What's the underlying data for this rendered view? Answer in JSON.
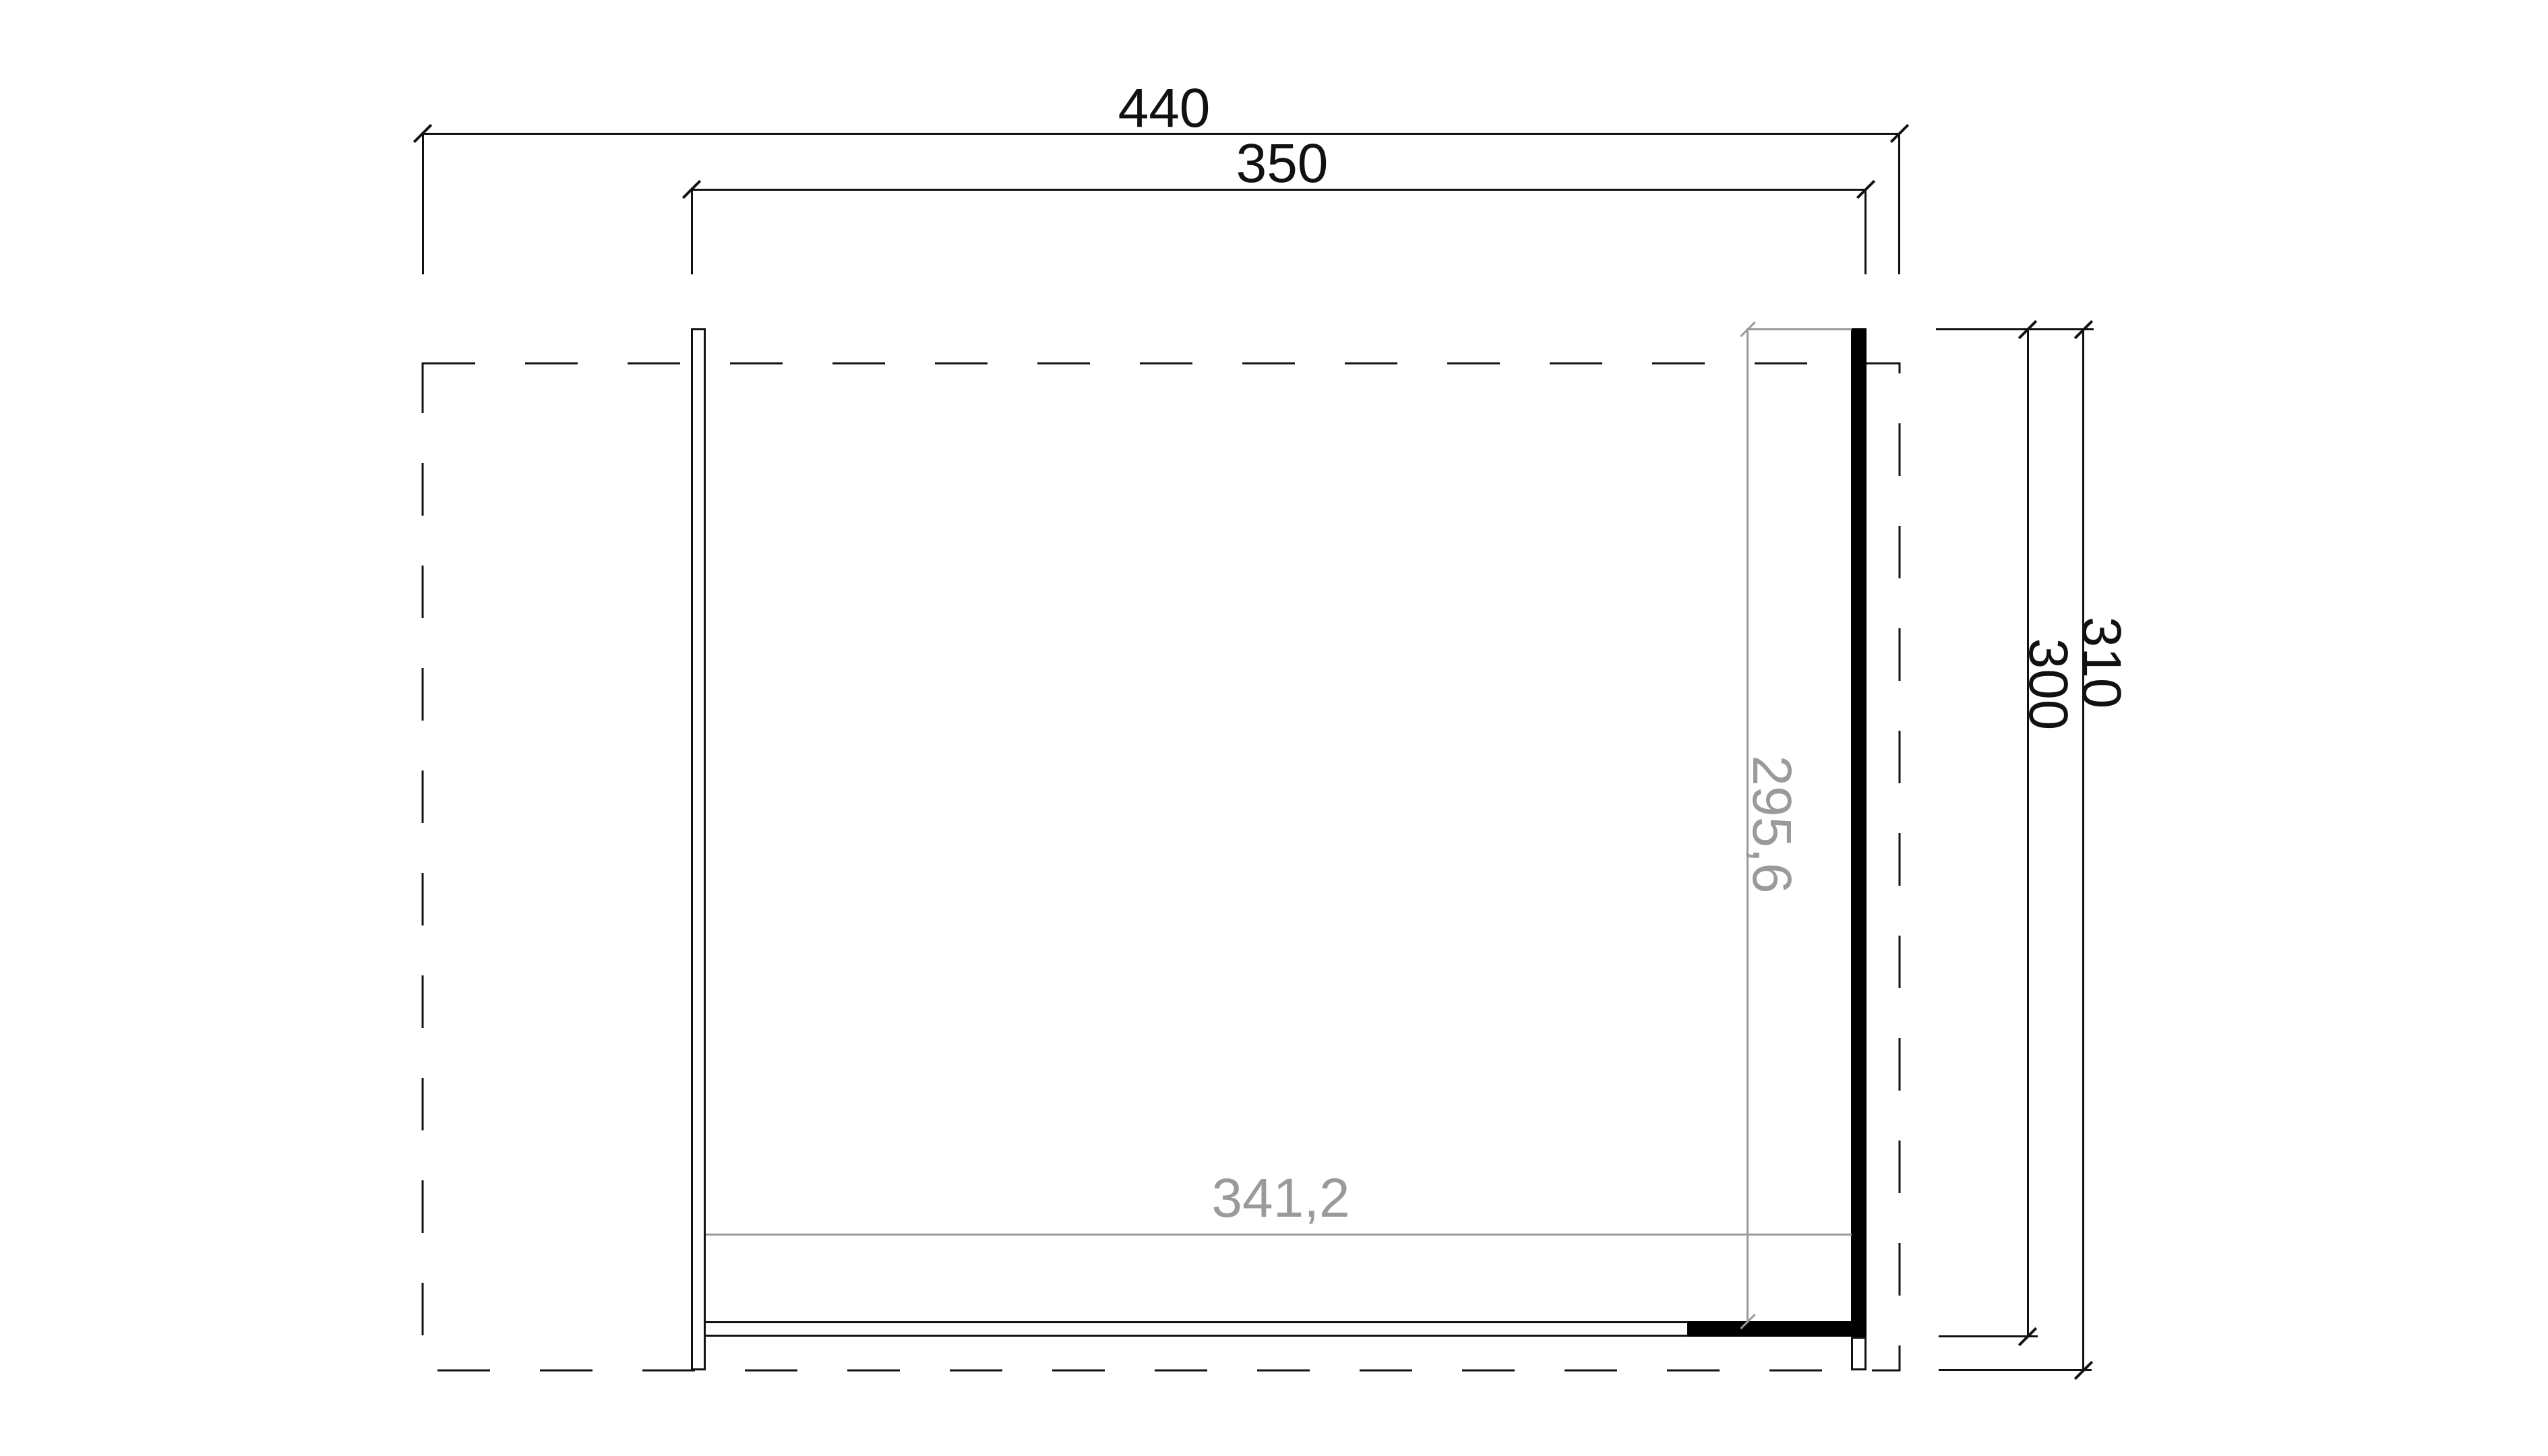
{
  "document": {
    "kind": "floor-plan dimension drawing",
    "background": "#ffffff",
    "line_color": "#111111",
    "secondary_dim_color": "#9a9a9a",
    "wall_fill_color": "#000000"
  },
  "dimensions": {
    "overall_width": "440",
    "wall_outer_width": "350",
    "side_wall_length": "310",
    "wall_outer_depth": "300",
    "interior_depth": "295,6",
    "interior_width": "341,2"
  }
}
